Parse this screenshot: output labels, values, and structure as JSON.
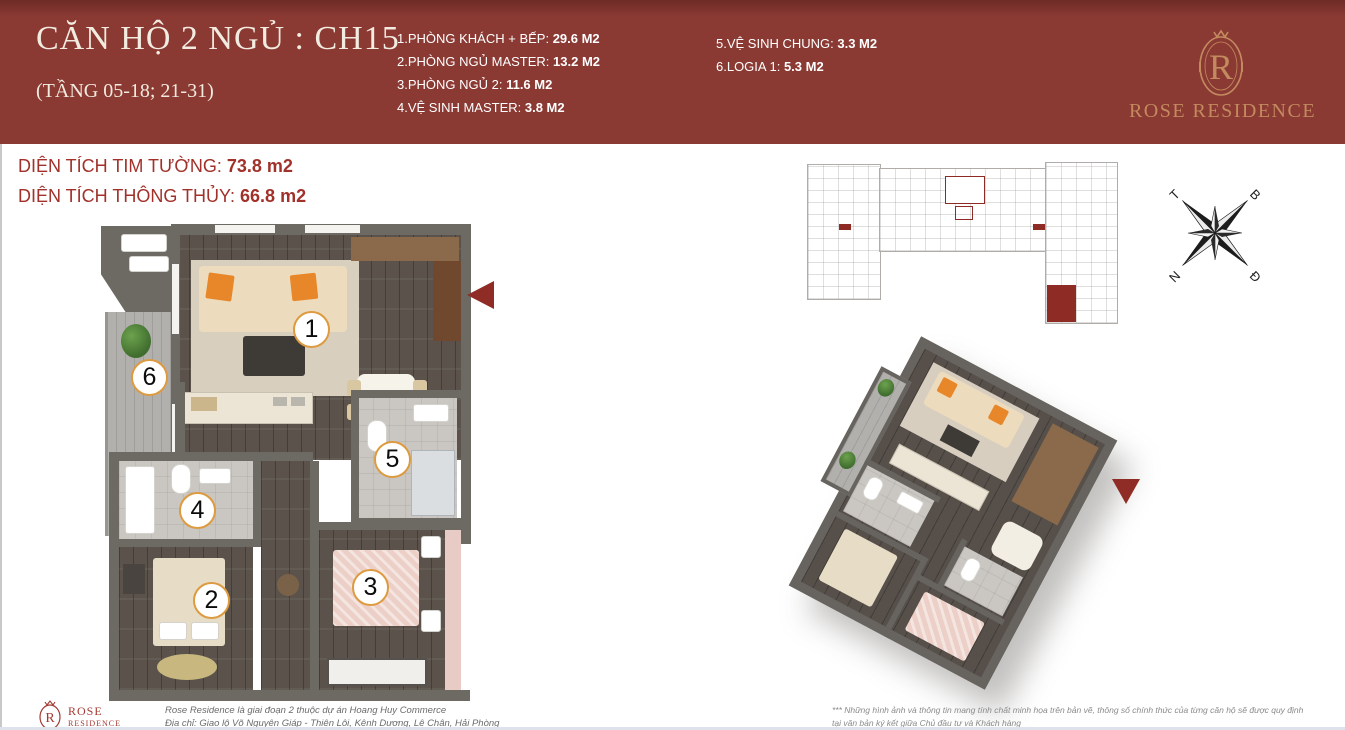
{
  "header": {
    "title": "CĂN HỘ 2 NGỦ : CH15",
    "floors": "(TẦNG 05-18; 21-31)",
    "rooms_col1": [
      {
        "label": "1.PHÒNG KHÁCH + BẾP: ",
        "area": "29.6 M2"
      },
      {
        "label": "2.PHÒNG NGỦ MASTER: ",
        "area": "13.2 M2"
      },
      {
        "label": "3.PHÒNG NGỦ 2: ",
        "area": "11.6 M2"
      },
      {
        "label": "4.VỆ SINH MASTER: ",
        "area": "3.8 M2"
      }
    ],
    "rooms_col2": [
      {
        "label": "5.VỆ SINH CHUNG: ",
        "area": "3.3 M2"
      },
      {
        "label": "6.LOGIA 1: ",
        "area": "5.3 M2"
      }
    ],
    "brand": {
      "monogram": "R",
      "name": "ROSE RESIDENCE"
    }
  },
  "areas": {
    "line1_label": "DIỆN TÍCH TIM TƯỜNG: ",
    "line1_value": "73.8 m2",
    "line2_label": "DIỆN TÍCH THÔNG THỦY: ",
    "line2_value": "66.8 m2"
  },
  "plan": {
    "markers": [
      "1",
      "2",
      "3",
      "4",
      "5",
      "6"
    ]
  },
  "compass": {
    "west": "T",
    "north": "B",
    "south": "N",
    "east": "Đ"
  },
  "footer": {
    "brand_monogram": "R",
    "brand_line1": "ROSE",
    "brand_line2": "RESIDENCE",
    "info_line1": "Rose Residence là giai đoạn 2 thuộc dự án Hoang Huy Commerce",
    "info_line2": "Địa chỉ: Giao lộ Võ Nguyên Giáp - Thiên Lôi, Kênh Dương, Lê Chân, Hải Phòng",
    "disclaimer_line1": "*** Những hình ảnh và thông tin mang tính chất minh họa trên bản vẽ, thông số chính thức của từng căn hộ sẽ được quy định",
    "disclaimer_line2": "tại văn bản ký kết giữa Chủ đầu tư và Khách hàng"
  },
  "colors": {
    "header_bg": "#8a3933",
    "accent_red": "#a1312a",
    "arrow_red": "#8e2c25",
    "gold": "#c28a5e"
  }
}
